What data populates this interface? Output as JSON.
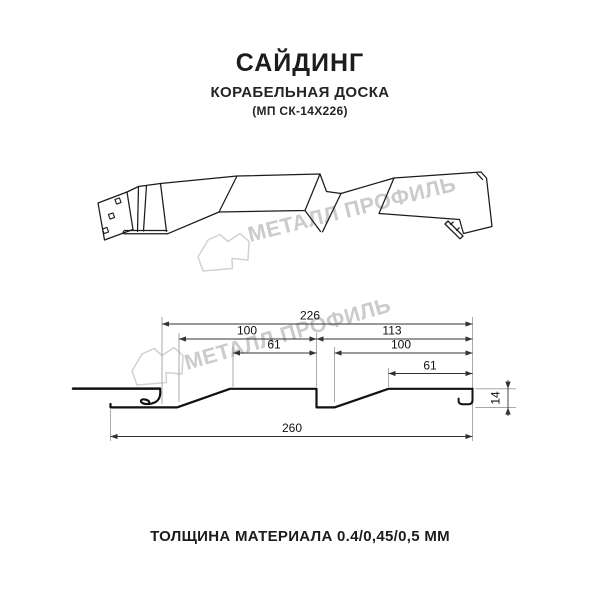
{
  "header": {
    "title": "САЙДИНГ",
    "subtitle": "КОРАБЕЛЬНАЯ ДОСКА",
    "code": "(МП СК-14Х226)"
  },
  "watermark": {
    "brand": "МЕТАЛЛ ПРОФИЛЬ",
    "icon": "metall-profil-logo-icon",
    "color": "#cbcbcb"
  },
  "drawing": {
    "dimensions": {
      "panel_width": "226",
      "left_pitch": "100",
      "right_pitch": "113",
      "left_crest": "61",
      "right_inner": "100",
      "right_crest": "61",
      "overall_width": "260",
      "profile_height": "14"
    }
  },
  "footer": {
    "thickness_note": "ТОЛЩИНА МАТЕРИАЛА 0.4/0,45/0,5 ММ"
  },
  "colors": {
    "line": "#1c1c1c",
    "profile": "#111111",
    "dimension": "#333333",
    "extension": "#9b9b9b",
    "background": "#ffffff"
  }
}
